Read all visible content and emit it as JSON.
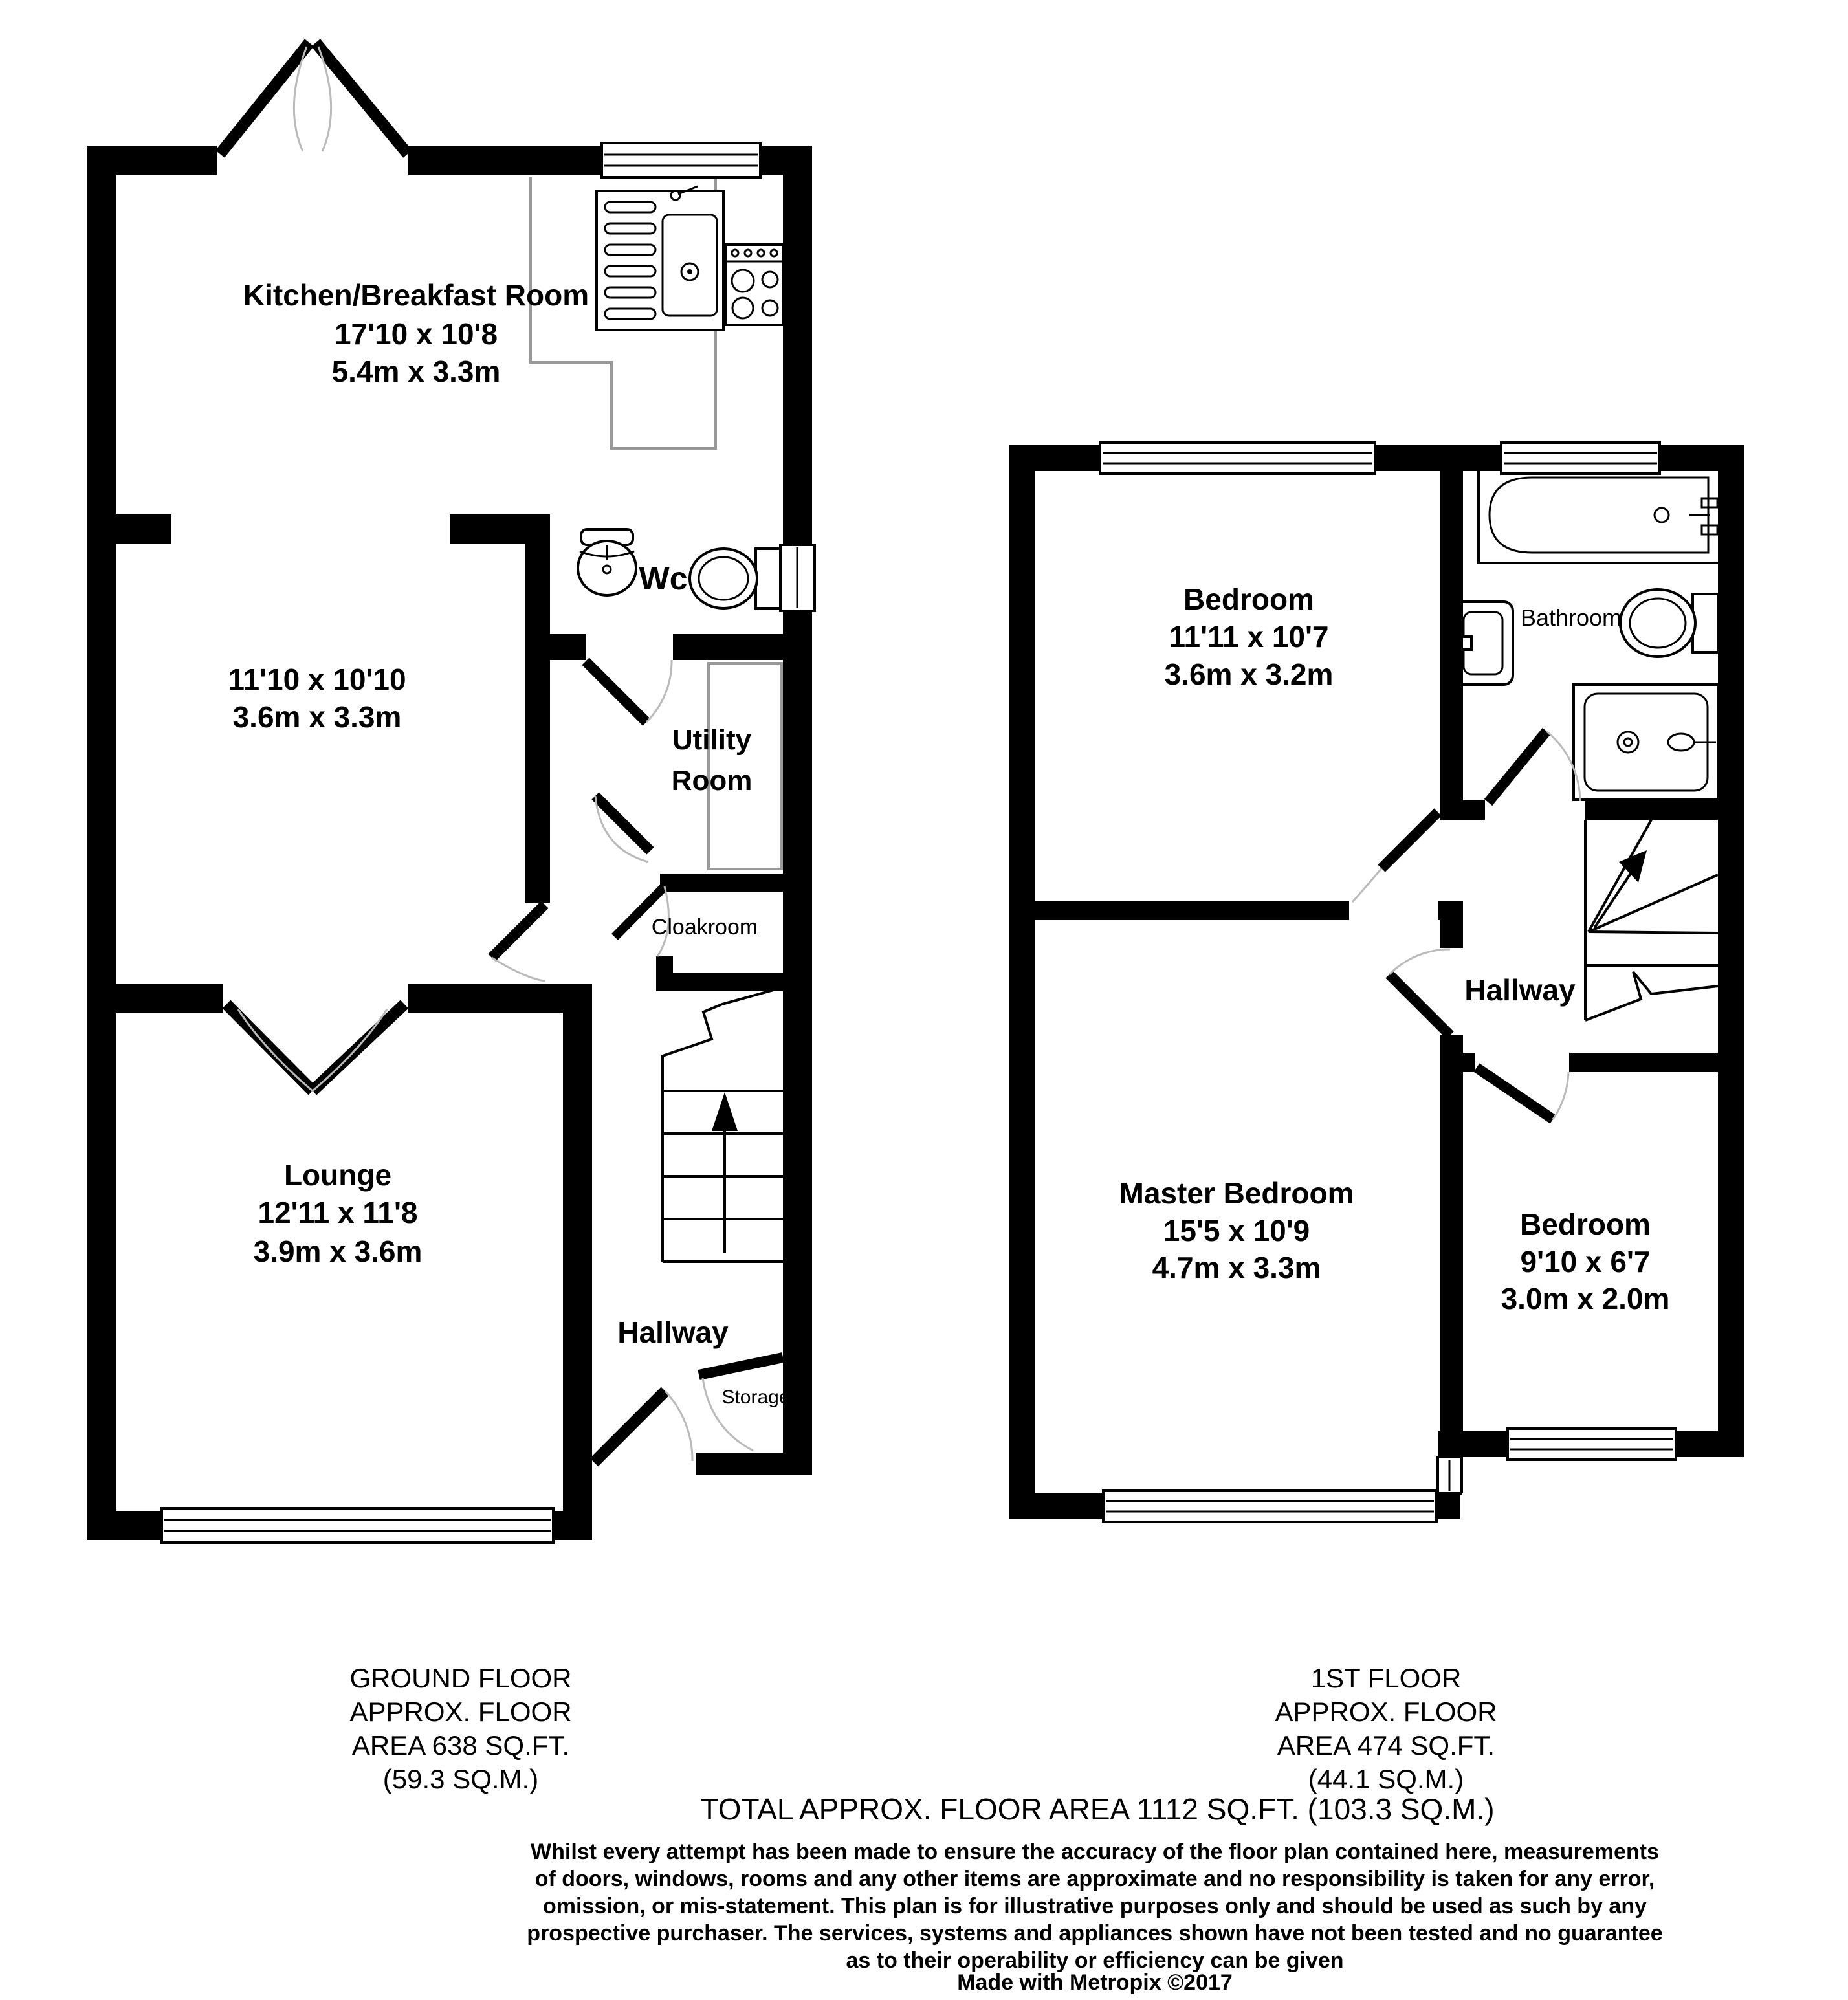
{
  "colors": {
    "wall": "#000000",
    "counter": "#999999",
    "door_arc": "#bababa",
    "background": "#ffffff"
  },
  "ground_floor": {
    "rooms": {
      "kitchen": {
        "name": "Kitchen/Breakfast Room",
        "size_imperial": "17'10 x 10'8",
        "size_metric": "5.4m x 3.3m"
      },
      "reception": {
        "size_imperial": "11'10 x 10'10",
        "size_metric": "3.6m x 3.3m"
      },
      "wc": {
        "name": "Wc"
      },
      "utility": {
        "name_line_1": "Utility",
        "name_line_2": "Room"
      },
      "cloakroom": {
        "name": "Cloakroom"
      },
      "lounge": {
        "name": "Lounge",
        "size_imperial": "12'11 x 11'8",
        "size_metric": "3.9m x 3.6m"
      },
      "hallway": {
        "name": "Hallway"
      },
      "storage": {
        "name": "Storage"
      }
    },
    "area_label": {
      "line_1": "GROUND FLOOR",
      "line_2": "APPROX. FLOOR",
      "line_3": "AREA 638 SQ.FT.",
      "line_4": "(59.3 SQ.M.)"
    }
  },
  "first_floor": {
    "rooms": {
      "bedroom_2": {
        "name": "Bedroom",
        "size_imperial": "11'11 x 10'7",
        "size_metric": "3.6m x 3.2m"
      },
      "bathroom": {
        "name": "Bathroom"
      },
      "hallway": {
        "name": "Hallway"
      },
      "master_bedroom": {
        "name": "Master Bedroom",
        "size_imperial": "15'5 x 10'9",
        "size_metric": "4.7m x 3.3m"
      },
      "bedroom_3": {
        "name": "Bedroom",
        "size_imperial": "9'10 x 6'7",
        "size_metric": "3.0m x 2.0m"
      }
    },
    "area_label": {
      "line_1": "1ST FLOOR",
      "line_2": "APPROX. FLOOR",
      "line_3": "AREA 474 SQ.FT.",
      "line_4": "(44.1 SQ.M.)"
    }
  },
  "summary": {
    "total_area": "TOTAL APPROX. FLOOR AREA 1112 SQ.FT. (103.3 SQ.M.)"
  },
  "disclaimer": {
    "lines": [
      "Whilst every attempt has been made to ensure the accuracy of the floor plan contained here, measurements",
      "of doors, windows, rooms and any other items are approximate and no responsibility is taken for any error,",
      "omission, or mis-statement. This plan is for illustrative purposes only and should be used as such by any",
      "prospective purchaser. The services, systems and appliances shown have not been tested and no guarantee",
      "as to their operability or efficiency can be given"
    ],
    "credit": "Made with Metropix ©2017"
  }
}
